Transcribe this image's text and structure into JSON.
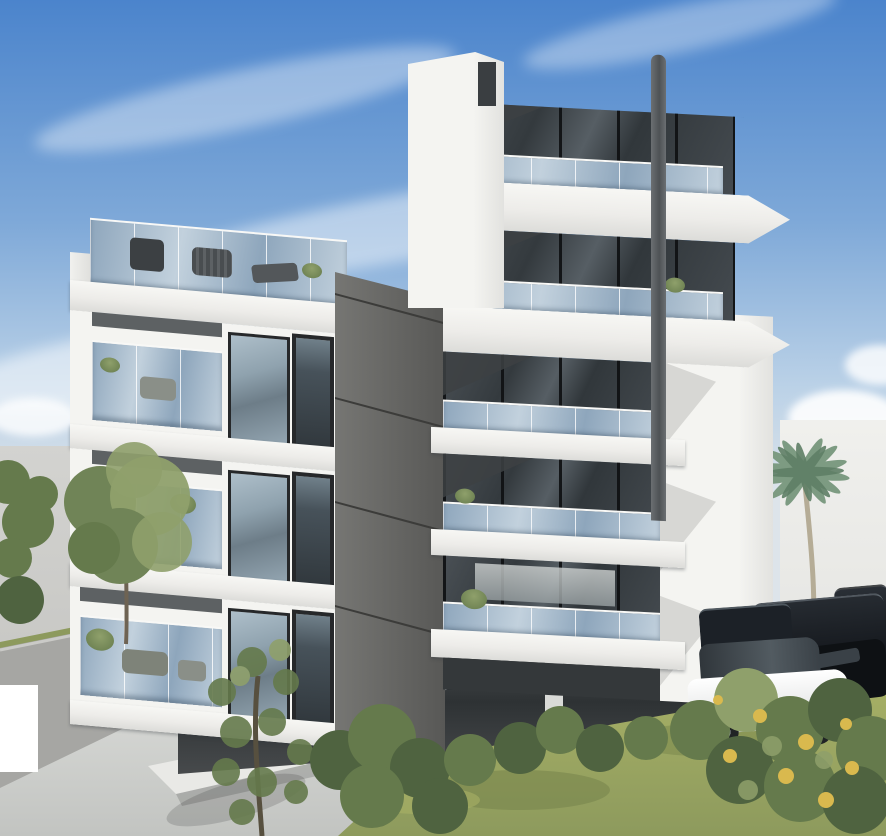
{
  "scene": {
    "setting": "Daytime 3D architectural exterior rendering of a modern white apartment complex with cantilevered balconies, seen from street corner",
    "sky": {
      "description": "Blue sky, lighter toward horizon, wispy cirrus streaks and small puffy clouds near the right wall",
      "horizon": "pale gray haze visible at left edge"
    },
    "buildings": {
      "left_block": {
        "floors_visible": 3,
        "roof_terrace": "glass-railed roof terrace with dark outdoor furniture silhouettes",
        "features": [
          "glass balcony railings",
          "balcony lounge furniture",
          "potted plants",
          "dark-framed sliding doors and tall windows",
          "open parking underneath"
        ]
      },
      "stair_core": {
        "description": "tall dark warm-gray vertical core slab with thin horizontal seam lines, supported on a concrete pillar"
      },
      "right_tower": {
        "floors_visible": 7,
        "features": [
          "white wedge-shaped cantilevered balcony slabs",
          "dark glazed facade bands",
          "blue-tinted glass balcony railings",
          "round gray rain pipe column through balcony edges",
          "white side pier with angular balcony notches",
          "white kitchen interior visible on a lower floor",
          "balcony plants"
        ]
      },
      "left_parapet": "tall white stair parapet wall with small dark notch window"
    },
    "vehicles": [
      {
        "label": "black hatchback with red wheel rim",
        "where": "under left block"
      },
      {
        "label": "silver sedan",
        "where": "under left block"
      },
      {
        "label": "white car, front view",
        "where": "under building behind pillar"
      },
      {
        "label": "dark car, partially hidden",
        "where": "under building"
      },
      {
        "label": "white SUV",
        "where": "right parking row, foreground"
      },
      {
        "label": "black sedan",
        "where": "right parking row"
      },
      {
        "label": "dark SUV",
        "where": "right parking row, behind"
      },
      {
        "label": "dark SUV, far, clipped at edge",
        "where": "right parking row"
      }
    ],
    "vegetation": [
      "green deciduous tree against left haze",
      "small bushes at far left edge",
      "sparse young tree in left foreground over driveway",
      "large green bush clusters at bottom center",
      "foreground shrub with yellow flowers at bottom right",
      "tall palm tree in front of right boundary wall",
      "small palm crown rising behind right shrub",
      "small plants on tower and left-block balconies"
    ],
    "ground": {
      "elements": [
        "light concrete driveway with dappled leaf shadows",
        "gray retaining wall at lower left with grass strip on top",
        "low white planter wall crossing diagonally",
        "large mottled yellow-green lawn at bottom",
        "white boundary wall on the right"
      ]
    },
    "misc": {
      "watermark_box": "blank white rectangle at bottom-left edge"
    }
  },
  "palette": {
    "sky_top": "#4b84cc",
    "sky_mid": "#7fa9d8",
    "sky_low": "#bad1e7",
    "sky_horizon": "#dde4ea",
    "distant_haze": "#c8c8c5",
    "boundary_wall": "#e8e8e5",
    "white_lit": "#f4f4f1",
    "white_shade": "#e2e2df",
    "slab_underside": "#c9c9c6",
    "soffit_shadow": "#3d4143",
    "glazing_dark": "#3f4448",
    "frame_dark": "#26282a",
    "rail_glass_a": "#8ea6bc",
    "rail_glass_b": "#c2d1dd",
    "core_dark_a": "#767673",
    "core_dark_b": "#585856",
    "core_seam": "#3c3c3a",
    "pillar_gray": "#b7b8b5",
    "concrete_lit": "#e3e4e1",
    "concrete_shade": "#c2c4c1",
    "parking_dark": "#2e3234",
    "grass_light": "#a8b166",
    "grass_base": "#8d9a5d",
    "grass_dark": "#6f7d47",
    "bush_dark": "#4f6340",
    "bush_mid": "#657a4c",
    "tree_green": "#708457",
    "tree_light": "#8fa06b",
    "palm_green": "#7d9b82",
    "palm_dark": "#5f7f66",
    "trunk_tan": "#b5ac96",
    "wall_gray": "#a6a6a3",
    "car_black": "#15181a",
    "car_silver": "#cdd1d3",
    "car_white": "#ebecec",
    "car_dark_navy": "#1c2127",
    "wheel_red": "#c0392b",
    "watermark_white": "#ffffff",
    "flower_yellow": "#d9b94e"
  }
}
